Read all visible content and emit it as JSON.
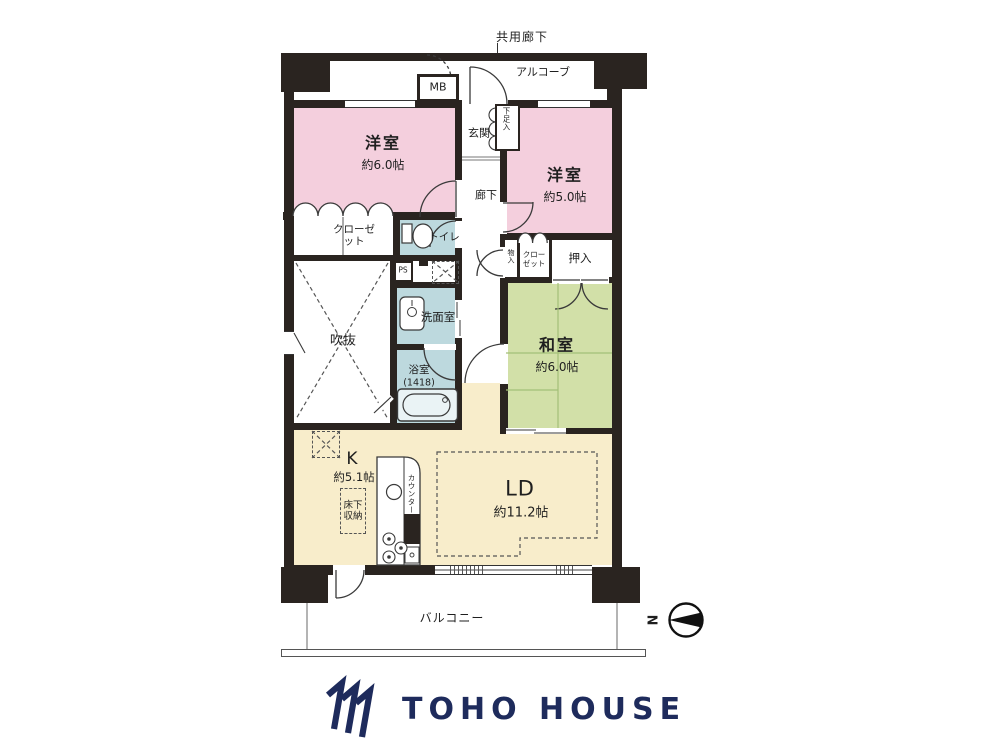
{
  "plan": {
    "common_corridor": "共用廊下",
    "alcove": "アルコーブ",
    "mb": "MB",
    "entrance": "玄関",
    "shoe_cabinet": "下足入",
    "hallway": "廊下",
    "western_room_1": {
      "name": "洋室",
      "area": "約6.0帖"
    },
    "western_room_2": {
      "name": "洋室",
      "area": "約5.0帖"
    },
    "japanese_room": {
      "name": "和室",
      "area": "約6.0帖"
    },
    "living_dining": {
      "name": "LD",
      "area": "約11.2帖"
    },
    "kitchen": {
      "name": "K",
      "area": "約5.1帖"
    },
    "closet_left": "クローゼット",
    "closet_right": "クローゼット",
    "toilet": "トイレ",
    "pipe_space": "PS",
    "void_space": "吹抜",
    "washroom": "洗面室",
    "bathroom": "浴室",
    "bathroom_size": "(1418)",
    "small_storage": "物入",
    "oshiire": "押入",
    "underfloor_storage": "床下収納",
    "counter": "カウンター",
    "balcony": "バルコニー",
    "compass_north": "N"
  },
  "branding": {
    "logo_text": "TOHO HOUSE",
    "logo_color": "#1e2b5c"
  },
  "colors": {
    "wall": "#2a2420",
    "western_room": "#f4cfdd",
    "japanese_room": "#d2e0a8",
    "living": "#f8edcb",
    "wet_area": "#bdd9de"
  }
}
